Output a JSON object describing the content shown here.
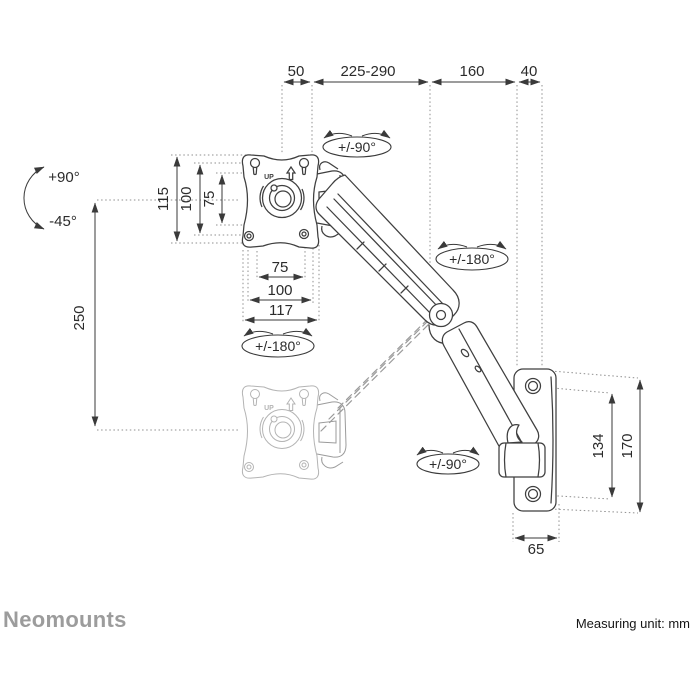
{
  "footer": {
    "brand": "Neomounts",
    "measuring_unit": "Measuring unit: mm"
  },
  "dims": {
    "top": [
      "50",
      "225-290",
      "160",
      "40"
    ],
    "tilt_up": "+90°",
    "tilt_down": "-45°",
    "lift_range": "250",
    "vesa_vertical": [
      "115",
      "100",
      "75"
    ],
    "vesa_horizontal": [
      "75",
      "100",
      "117"
    ],
    "wall_hole_spacing": "134",
    "wall_plate_height": "170",
    "wall_plate_width": "65"
  },
  "rotation_labels": {
    "swivel_top": "+/-90°",
    "rotate_mid": "+/-180°",
    "rotate_plate": "+/-180°",
    "swivel_wall": "+/-90°"
  },
  "plate": {
    "up_label": "UP"
  },
  "colors": {
    "line": "#3a3a3a",
    "dotted": "#8f8f8f",
    "ghost": "#b4b4b4",
    "brand_gray": "#9c9c9c"
  }
}
